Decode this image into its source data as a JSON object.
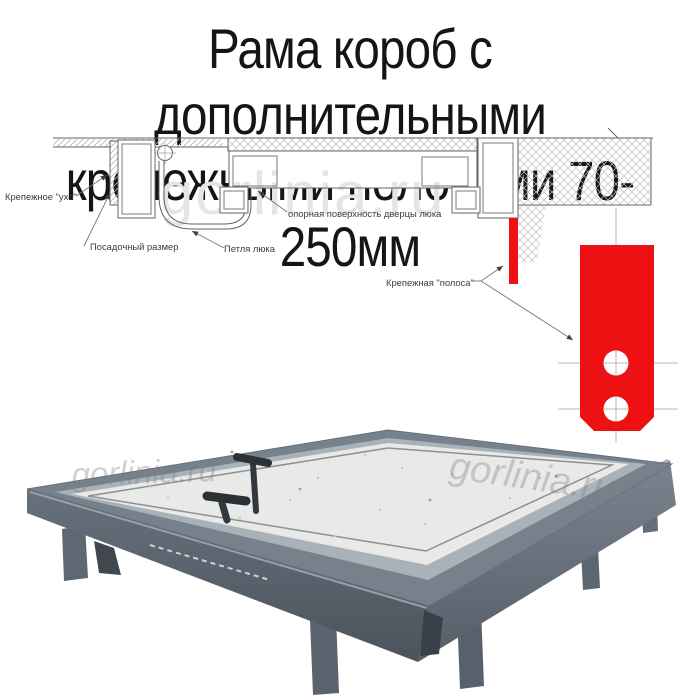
{
  "title": {
    "line1": "Рама короб с дополнительными",
    "line2": "крепежными полосами 70-250мм"
  },
  "watermark": {
    "text": "gorlinia.ru"
  },
  "diagram": {
    "labels": {
      "ear": "Крепежное \"ухо\"",
      "mounting_size": "Посадочный размер",
      "hinge": "Петля люка",
      "support_surface": "опорная поверхность дверцы люка",
      "fastening_strip": "Крепежная \"полоса\""
    },
    "colors": {
      "strip_red": "#ee1114",
      "line_gray": "#666666",
      "hatch_gray": "#bcbcbc"
    }
  },
  "photo": {
    "colors": {
      "frame_top": "#76818c",
      "aluminum": "#a9b2b9",
      "panel": "#e9eae7",
      "leg": "#5a646f",
      "handle": "#2c3136"
    }
  }
}
